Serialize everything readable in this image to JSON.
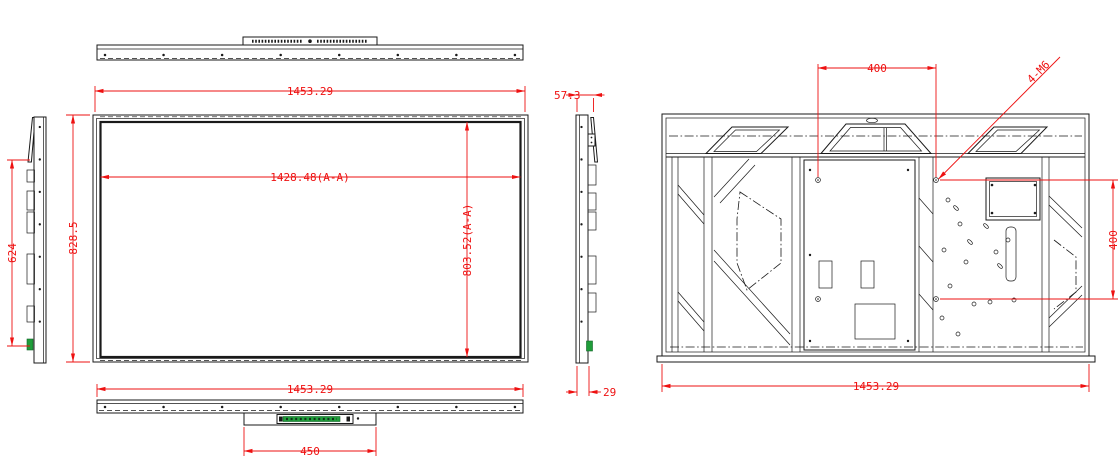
{
  "dims": {
    "front_overall_width": "1453.29",
    "front_active_width": "1428.48(A-A)",
    "front_overall_height": "828.5",
    "front_active_height": "803.52(A-A)",
    "bottom_overall_width": "1453.29",
    "bottom_module_width": "450",
    "left_port_zone_height": "624",
    "side_overall_depth": "57.3",
    "side_body_depth": "29",
    "rear_vesa_width": "400",
    "rear_vesa_height": "400",
    "rear_mount_screws": "4-M6",
    "rear_overall_width": "1453.29"
  },
  "colors": {
    "linework": "#1a1a1a",
    "dimension_red": "#ee1111",
    "connector_green": "#1f9d3a"
  }
}
